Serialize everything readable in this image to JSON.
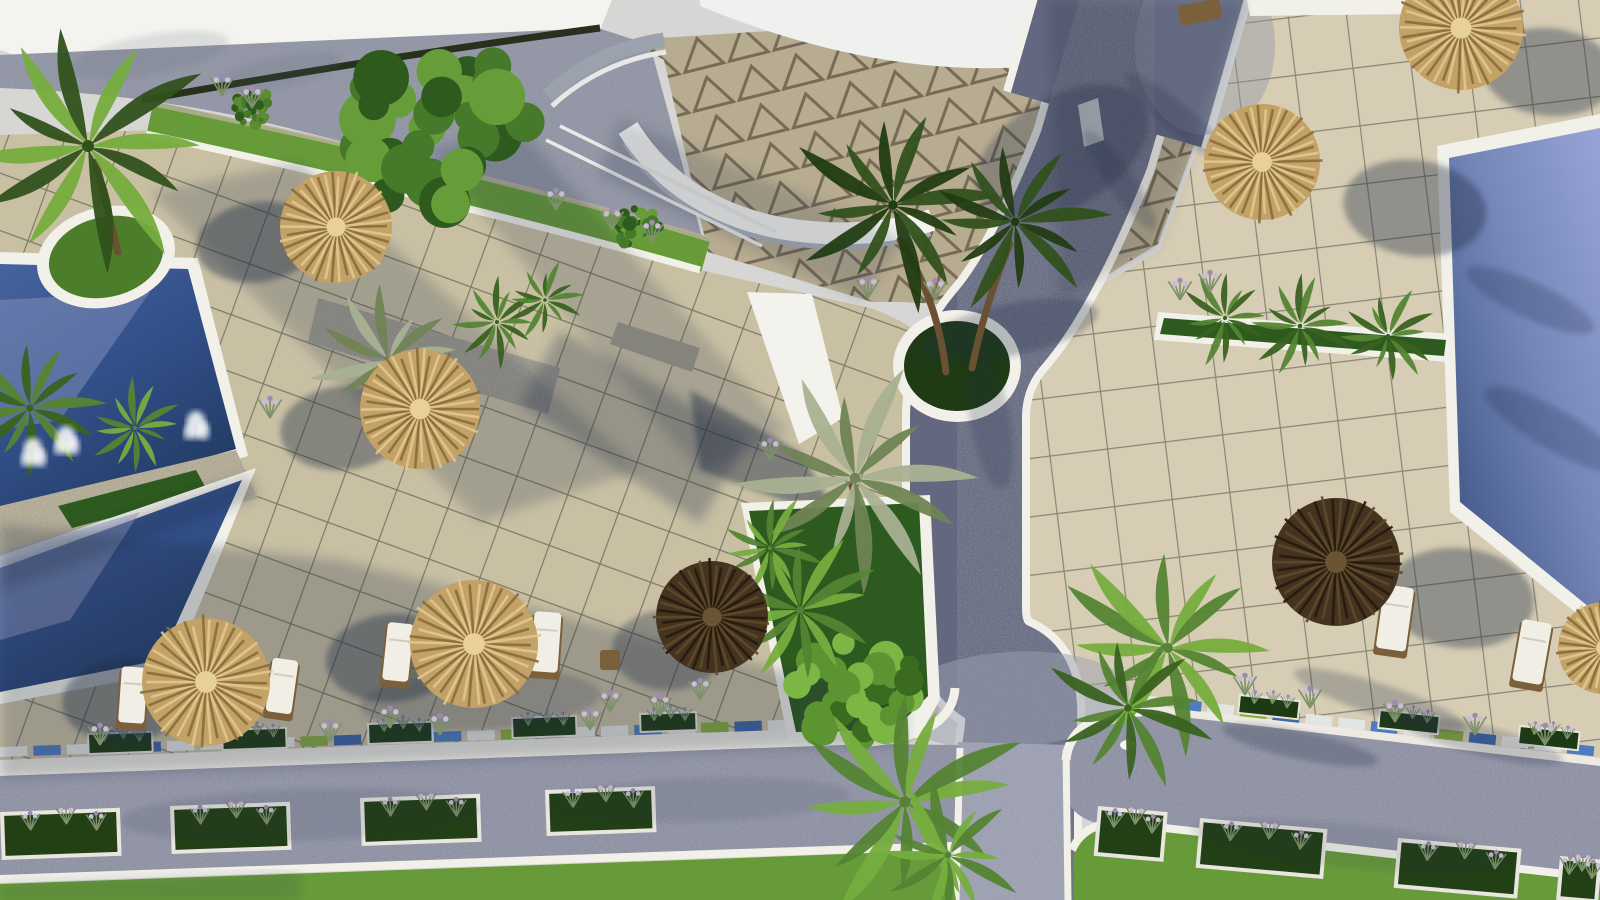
{
  "meta": {
    "description": "Aerial 3D architectural rendering of a resort courtyard: two dark-blue pools with a planted stone divider and fountains on the left, a light-blue pool on the upper right, beige tiled sun terraces with thatched umbrellas and white loungers, a curved white pavilion with triangle-patterned paving at top, a grey cobbled path running down the middle, and a bottom road lined with white flower planters beside a green lawn."
  },
  "colors": {
    "sky": "#d6d6d4",
    "roofWhite": "#f3f3f0",
    "walkway": "#8f93a3",
    "hedge": "#26301d",
    "triBg": "#b7ab8d",
    "triLine": "#5f5340",
    "tileSun": "#c9c0a4",
    "tileSunR": "#d6cdb4",
    "tileLine": "#3c3f33",
    "curb": "#f1f0e9",
    "pathCol": "#636880",
    "pathLight": "#9b9fb2",
    "roadCol": "#8b8fa2",
    "wallWhite": "#eceae2",
    "stone": "#b2a98f",
    "lawn": "#679b3a",
    "innerGrass": "#4c7d2b",
    "bedGreen": "#2d5a1e",
    "trunk": "#6b5134",
    "slabWhite": "#f3f2ec",
    "pavGray": "#9ba1ad",
    "shadowCol": "#222d47",
    "thatchBase": "#c2a266",
    "umbrellaDark": "#44341f",
    "cushion": "#f0eee5",
    "frame": "#7c5f3b",
    "plume": "#c7bdd6"
  },
  "scene": {
    "mosaics": [
      {
        "x1": 0,
        "y1": 752,
        "x2": 868,
        "y2": 722,
        "n": 26
      },
      {
        "x1": 1142,
        "y1": 700,
        "x2": 1600,
        "y2": 752,
        "n": 14
      }
    ],
    "mosaicColors": [
      "#e3e5e2",
      "#4e7dbf",
      "#e3e5e2",
      "#88ad3d",
      "#3e65a6",
      "#e3e5e2"
    ],
    "planters": [
      {
        "x": 0,
        "y": 812,
        "w": 120,
        "h": 48,
        "rot": -2,
        "f": 1
      },
      {
        "x": 170,
        "y": 806,
        "w": 120,
        "h": 48,
        "rot": -2,
        "f": 1
      },
      {
        "x": 360,
        "y": 798,
        "w": 120,
        "h": 48,
        "rot": -2,
        "f": 1
      },
      {
        "x": 545,
        "y": 790,
        "w": 110,
        "h": 46,
        "rot": -2,
        "f": 1
      },
      {
        "x": 1098,
        "y": 806,
        "w": 70,
        "h": 50,
        "rot": 5,
        "f": 1
      },
      {
        "x": 1200,
        "y": 818,
        "w": 128,
        "h": 50,
        "rot": 5,
        "f": 1
      },
      {
        "x": 1398,
        "y": 838,
        "w": 124,
        "h": 50,
        "rot": 5,
        "f": 1
      },
      {
        "x": 1560,
        "y": 856,
        "w": 42,
        "h": 44,
        "rot": 5,
        "f": 1
      },
      {
        "x": 88,
        "y": 734,
        "w": 64,
        "h": 20,
        "rot": -2,
        "f": 0
      },
      {
        "x": 222,
        "y": 730,
        "w": 64,
        "h": 20,
        "rot": -2,
        "f": 0
      },
      {
        "x": 368,
        "y": 724,
        "w": 64,
        "h": 20,
        "rot": -2,
        "f": 0
      },
      {
        "x": 512,
        "y": 718,
        "w": 64,
        "h": 20,
        "rot": -2,
        "f": 0
      },
      {
        "x": 640,
        "y": 714,
        "w": 56,
        "h": 18,
        "rot": -2,
        "f": 0
      },
      {
        "x": 1240,
        "y": 695,
        "w": 60,
        "h": 18,
        "rot": 6,
        "f": 0
      },
      {
        "x": 1380,
        "y": 710,
        "w": 60,
        "h": 18,
        "rot": 6,
        "f": 0
      },
      {
        "x": 1520,
        "y": 726,
        "w": 60,
        "h": 18,
        "rot": 6,
        "f": 0
      }
    ],
    "plumes": [
      [
        222,
        96
      ],
      [
        252,
        108
      ],
      [
        556,
        210
      ],
      [
        612,
        230
      ],
      [
        652,
        242
      ],
      [
        270,
        418
      ],
      [
        390,
        728
      ],
      [
        440,
        735
      ],
      [
        610,
        712
      ],
      [
        660,
        716
      ],
      [
        700,
        700
      ],
      [
        1245,
        695
      ],
      [
        1310,
        708
      ],
      [
        1395,
        722
      ],
      [
        1475,
        735
      ],
      [
        1545,
        745
      ],
      [
        1180,
        300
      ],
      [
        1210,
        292
      ],
      [
        100,
        745
      ],
      [
        330,
        742
      ],
      [
        590,
        730
      ],
      [
        770,
        460
      ],
      [
        935,
        300
      ],
      [
        868,
        298
      ]
    ],
    "splashes": [
      [
        33,
        452
      ],
      [
        66,
        440
      ],
      [
        196,
        425
      ]
    ],
    "trunks": [
      {
        "d": "M946,372 Q938,300 900,240"
      },
      {
        "d": "M972,368 Q986,300 1010,244"
      },
      {
        "d": "M118,252 Q108,210 96,162"
      },
      {
        "d": "M862,540 Q858,505 852,486"
      }
    ],
    "bushes": [
      {
        "x": 438,
        "y": 128,
        "r": 95,
        "seed": 3,
        "cols": [
          "#2f5a1d",
          "#47792a",
          "#669d39"
        ]
      },
      {
        "x": 858,
        "y": 692,
        "r": 62,
        "seed": 9,
        "cols": [
          "#3a6b1f",
          "#5b9430",
          "#7cb645"
        ]
      },
      {
        "x": 640,
        "y": 228,
        "r": 24,
        "seed": 5,
        "cols": [
          "#2f5a1d",
          "#47792a",
          "#669d39"
        ]
      },
      {
        "x": 254,
        "y": 108,
        "r": 20,
        "seed": 7,
        "cols": [
          "#2f5a1d",
          "#47792a",
          "#5b8c32"
        ]
      }
    ],
    "palms": [
      {
        "x": 88,
        "y": 146,
        "s": 1.5,
        "tone": "mix",
        "seed": 1
      },
      {
        "x": 30,
        "y": 408,
        "s": 0.9,
        "tone": "mid",
        "seed": 2
      },
      {
        "x": 135,
        "y": 428,
        "s": 0.55,
        "tone": "bright",
        "seed": 3
      },
      {
        "x": 388,
        "y": 360,
        "s": 0.85,
        "tone": "silver",
        "seed": 4
      },
      {
        "x": 497,
        "y": 322,
        "s": 0.5,
        "tone": "mid",
        "seed": 5
      },
      {
        "x": 545,
        "y": 300,
        "s": 0.45,
        "tone": "mid",
        "seed": 15
      },
      {
        "x": 855,
        "y": 478,
        "s": 1.3,
        "tone": "silver",
        "seed": 6
      },
      {
        "x": 893,
        "y": 205,
        "s": 1.2,
        "tone": "dark",
        "seed": 7
      },
      {
        "x": 1015,
        "y": 222,
        "s": 1.05,
        "tone": "dark",
        "seed": 8
      },
      {
        "x": 770,
        "y": 548,
        "s": 0.6,
        "tone": "bright",
        "seed": 9
      },
      {
        "x": 800,
        "y": 610,
        "s": 0.95,
        "tone": "bright",
        "seed": 10
      },
      {
        "x": 1225,
        "y": 318,
        "s": 0.55,
        "tone": "mid",
        "seed": 11
      },
      {
        "x": 1300,
        "y": 326,
        "s": 0.6,
        "tone": "mid",
        "seed": 12
      },
      {
        "x": 1388,
        "y": 336,
        "s": 0.55,
        "tone": "mid",
        "seed": 13
      },
      {
        "x": 1168,
        "y": 648,
        "s": 1.25,
        "tone": "bright",
        "seed": 14
      },
      {
        "x": 1128,
        "y": 708,
        "s": 0.95,
        "tone": "mid",
        "seed": 16
      },
      {
        "x": 905,
        "y": 802,
        "s": 1.4,
        "tone": "bright",
        "seed": 17
      },
      {
        "x": 948,
        "y": 855,
        "s": 0.85,
        "tone": "bright",
        "seed": 18
      }
    ],
    "loungers": [
      {
        "x": 398,
        "y": 652,
        "w": 26,
        "h": 58,
        "rot": 6,
        "t": "lounger"
      },
      {
        "x": 546,
        "y": 642,
        "w": 27,
        "h": 60,
        "rot": 4,
        "t": "lounger"
      },
      {
        "x": 610,
        "y": 660,
        "w": 20,
        "h": 20,
        "rot": 0,
        "t": "stool"
      },
      {
        "x": 133,
        "y": 695,
        "w": 26,
        "h": 56,
        "rot": 4,
        "t": "lounger"
      },
      {
        "x": 282,
        "y": 686,
        "w": 26,
        "h": 54,
        "rot": 8,
        "t": "lounger"
      },
      {
        "x": 1395,
        "y": 618,
        "w": 30,
        "h": 64,
        "rot": 8,
        "t": "lounger"
      },
      {
        "x": 1532,
        "y": 652,
        "w": 30,
        "h": 62,
        "rot": 10,
        "t": "lounger"
      },
      {
        "x": 1200,
        "y": 12,
        "w": 42,
        "h": 20,
        "rot": -12,
        "t": "bench"
      }
    ],
    "umbrellas": [
      {
        "x": 336,
        "y": 227,
        "r": 56,
        "tone": "light"
      },
      {
        "x": 420,
        "y": 409,
        "r": 60,
        "tone": "light"
      },
      {
        "x": 474,
        "y": 644,
        "r": 64,
        "tone": "light"
      },
      {
        "x": 206,
        "y": 682,
        "r": 64,
        "tone": "light"
      },
      {
        "x": 712,
        "y": 617,
        "r": 56,
        "tone": "dark"
      },
      {
        "x": 1262,
        "y": 162,
        "r": 58,
        "tone": "light"
      },
      {
        "x": 1461,
        "y": 28,
        "r": 62,
        "tone": "light"
      },
      {
        "x": 1336,
        "y": 562,
        "r": 64,
        "tone": "dark"
      },
      {
        "x": 1604,
        "y": 648,
        "r": 46,
        "tone": "light"
      }
    ],
    "shadows": [
      {
        "t": "e",
        "cx": 258,
        "cy": 242,
        "rx": 62,
        "ry": 40,
        "rot": -8,
        "op": 0.42
      },
      {
        "t": "e",
        "cx": 344,
        "cy": 428,
        "rx": 64,
        "ry": 42,
        "rot": -6,
        "op": 0.4
      },
      {
        "t": "e",
        "cx": 392,
        "cy": 658,
        "rx": 66,
        "ry": 44,
        "rot": -5,
        "op": 0.4
      },
      {
        "t": "e",
        "cx": 126,
        "cy": 700,
        "rx": 64,
        "ry": 42,
        "rot": -5,
        "op": 0.4
      },
      {
        "t": "e",
        "cx": 668,
        "cy": 650,
        "rx": 56,
        "ry": 40,
        "rot": 0,
        "op": 0.35
      },
      {
        "t": "e",
        "cx": 1415,
        "cy": 208,
        "rx": 72,
        "ry": 48,
        "rot": 8,
        "op": 0.38
      },
      {
        "t": "e",
        "cx": 1549,
        "cy": 72,
        "rx": 66,
        "ry": 44,
        "rot": 6,
        "op": 0.38
      },
      {
        "t": "e",
        "cx": 1460,
        "cy": 598,
        "rx": 74,
        "ry": 50,
        "rot": 6,
        "op": 0.38
      },
      {
        "t": "p",
        "pts": "150,192 300,162 640,470 480,522",
        "op": 0.22
      },
      {
        "t": "p",
        "pts": "428,150 520,128 788,432 700,472",
        "op": 0.2
      },
      {
        "t": "p",
        "pts": "0,524 340,560 700,650 905,700 905,745 770,748 0,778",
        "op": 0.26
      },
      {
        "t": "p",
        "pts": "620,118 905,238 862,300 598,176",
        "op": 0.18
      },
      {
        "t": "e",
        "cx": 1062,
        "cy": 152,
        "rx": 95,
        "ry": 55,
        "rot": -30,
        "op": 0.3
      },
      {
        "t": "e",
        "cx": 1010,
        "cy": 330,
        "rx": 90,
        "ry": 26,
        "rot": -12,
        "op": 0.28
      },
      {
        "t": "e",
        "cx": 990,
        "cy": 420,
        "rx": 70,
        "ry": 20,
        "rot": 80,
        "op": 0.2
      },
      {
        "t": "e",
        "cx": 1380,
        "cy": 700,
        "rx": 90,
        "ry": 16,
        "rot": 18,
        "op": 0.25
      },
      {
        "t": "e",
        "cx": 1300,
        "cy": 745,
        "rx": 80,
        "ry": 14,
        "rot": 12,
        "op": 0.25
      },
      {
        "t": "e",
        "cx": 1480,
        "cy": 740,
        "rx": 85,
        "ry": 15,
        "rot": 14,
        "op": 0.22
      },
      {
        "t": "e",
        "cx": 1180,
        "cy": 120,
        "rx": 70,
        "ry": 14,
        "rot": 40,
        "op": 0.2
      },
      {
        "t": "e",
        "cx": 1120,
        "cy": 180,
        "rx": 60,
        "ry": 13,
        "rot": 55,
        "op": 0.2
      },
      {
        "t": "e",
        "cx": 150,
        "cy": 55,
        "rx": 80,
        "ry": 20,
        "rot": -10,
        "op": 0.15,
        "f": "#5a6372"
      },
      {
        "t": "e",
        "cx": 280,
        "cy": 72,
        "rx": 64,
        "ry": 16,
        "rot": -12,
        "op": 0.14,
        "f": "#5a6372"
      },
      {
        "t": "e",
        "cx": 300,
        "cy": 815,
        "rx": 180,
        "ry": 26,
        "rot": -2,
        "op": 0.12
      },
      {
        "t": "e",
        "cx": 700,
        "cy": 800,
        "rx": 150,
        "ry": 22,
        "rot": -2,
        "op": 0.1
      },
      {
        "t": "e",
        "cx": 1350,
        "cy": 846,
        "rx": 160,
        "ry": 22,
        "rot": 6,
        "op": 0.1
      },
      {
        "t": "p",
        "pts": "0,560 250,474 258,498 0,592",
        "op": 0.22,
        "f": "#101c33"
      },
      {
        "t": "p",
        "pts": "1048,0 1245,0 1158,246 1060,300",
        "op": 0.18,
        "f": "#1a2136"
      },
      {
        "t": "p",
        "pts": "560,330 748,438 700,524 520,404",
        "op": 0.3
      },
      {
        "t": "e",
        "cx": 480,
        "cy": 700,
        "rx": 120,
        "ry": 30,
        "rot": -3,
        "op": 0.2
      },
      {
        "t": "e",
        "cx": 1530,
        "cy": 300,
        "rx": 70,
        "ry": 18,
        "rot": 25,
        "op": 0.2,
        "f": "#0e1b33"
      },
      {
        "t": "e",
        "cx": 1555,
        "cy": 430,
        "rx": 80,
        "ry": 20,
        "rot": 30,
        "op": 0.2,
        "f": "#0e1b33"
      },
      {
        "t": "p",
        "pts": "0,884 300,872 300,900 0,900",
        "op": 0.15
      }
    ]
  }
}
